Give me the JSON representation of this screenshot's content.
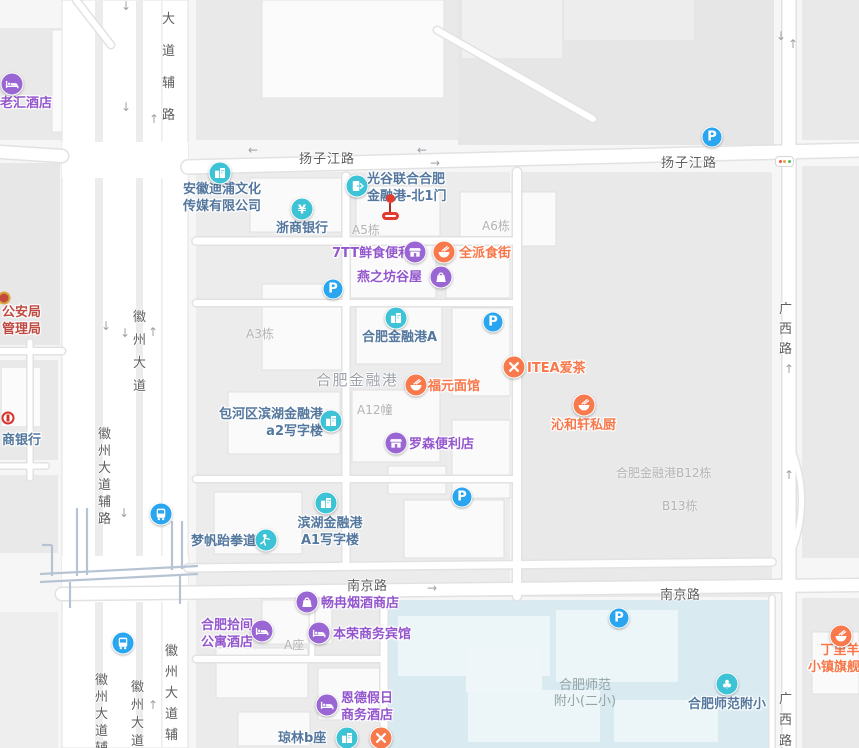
{
  "colors": {
    "teal": "#3ec3d6",
    "purple": "#9a66d4",
    "orange": "#f8794b",
    "parking_blue": "#2aa6f0",
    "transit_blue": "#2aa6f0",
    "poi_text_blue": "#54779e",
    "poi_text_purple": "#9356cd",
    "poi_text_orange": "#f8774a",
    "building_label_gray": "#b3b3b3",
    "area_label_gray": "#9da3aa",
    "school_text": "#92a4a6",
    "government_red": "#bf4a42",
    "road_text": "#5e5e5e",
    "marker_red": "#e23b30",
    "school_area_fill": "#d9eaf0",
    "bank_logo_red": "#d5342c"
  },
  "map": {
    "road_labels": [
      {
        "text": "扬子江路",
        "x": 299,
        "y": 148,
        "v": false,
        "ls": 1
      },
      {
        "text": "扬子江路",
        "x": 661,
        "y": 152,
        "v": false,
        "ls": 1
      },
      {
        "text": "南京路",
        "x": 347,
        "y": 575,
        "v": false,
        "ls": 0.5
      },
      {
        "text": "南京路",
        "x": 660,
        "y": 584,
        "v": false,
        "ls": 0.5
      },
      {
        "text": "徽州大道",
        "x": 132,
        "y": 306,
        "v": true,
        "gap": 23
      },
      {
        "text": "大道辅路",
        "x": 161,
        "y": 4,
        "v": true,
        "gap": 32
      },
      {
        "text": "徽州大道辅路",
        "x": 97,
        "y": 426,
        "v": true,
        "gap": 17
      },
      {
        "text": "徽州大道辅路",
        "x": 94,
        "y": 672,
        "v": true,
        "gap": 17
      },
      {
        "text": "徽州大道",
        "x": 130,
        "y": 679,
        "v": true,
        "gap": 18
      },
      {
        "text": "徽州大道辅路",
        "x": 164,
        "y": 641,
        "v": true,
        "gap": 21
      },
      {
        "text": "广西路",
        "x": 778,
        "y": 300,
        "v": true,
        "gap": 20
      },
      {
        "text": "广西路",
        "x": 778,
        "y": 689,
        "v": true,
        "gap": 21
      }
    ],
    "area_labels": [
      {
        "text": "合肥金融港",
        "x": 316,
        "y": 369,
        "kind": "district"
      },
      {
        "text": "合肥师范\n附小(二小)",
        "x": 547,
        "y": 678,
        "w": 76,
        "kind": "school"
      }
    ],
    "building_labels": [
      {
        "text": "A5栋",
        "x": 352,
        "y": 221
      },
      {
        "text": "A6栋",
        "x": 482,
        "y": 217
      },
      {
        "text": "A3栋",
        "x": 246,
        "y": 325
      },
      {
        "text": "A12幢",
        "x": 357,
        "y": 401
      },
      {
        "text": "合肥金融港B12栋",
        "x": 616,
        "y": 464
      },
      {
        "text": "B13栋",
        "x": 662,
        "y": 497
      },
      {
        "text": "A座",
        "x": 284,
        "y": 636
      }
    ],
    "pois": [
      {
        "id": "laohui-hotel",
        "icon": "bed",
        "icon_color": "purple",
        "ix": 12,
        "iy": 84,
        "text": "老汇酒店",
        "text_color": "purple",
        "tx": 0,
        "ty": 95
      },
      {
        "id": "anhui-dipu-media",
        "icon": "building",
        "icon_color": "teal",
        "ix": 220,
        "iy": 173,
        "text": "安徽迪浦文化\n传媒有限公司",
        "text_color": "blue",
        "tx": 183,
        "ty": 181
      },
      {
        "id": "zheshang-bank",
        "icon": "yen",
        "icon_color": "teal",
        "ix": 302,
        "iy": 209,
        "text": "浙商银行",
        "text_color": "blue",
        "tx": 276,
        "ty": 220
      },
      {
        "id": "guanggu-north-gate1",
        "icon": "door",
        "icon_color": "teal",
        "ix": 357,
        "iy": 186,
        "text": "光谷联合合肥\n金融港-北1门",
        "text_color": "blue",
        "tx": 367,
        "ty": 171
      },
      {
        "id": "7tt-convenience",
        "icon": "shop",
        "icon_color": "purple",
        "ix": 415,
        "iy": 252,
        "text": "7TT鲜食便利",
        "text_color": "purple",
        "tx": 332,
        "ty": 245
      },
      {
        "id": "quanpai-food-street",
        "icon": "bowl",
        "icon_color": "orange",
        "ix": 444,
        "iy": 252,
        "text": "全派食街",
        "text_color": "orange",
        "tx": 459,
        "ty": 245
      },
      {
        "id": "yanzhifang-guwu",
        "icon": "bag",
        "icon_color": "purple",
        "ix": 441,
        "iy": 277,
        "text": "燕之坊谷屋",
        "text_color": "purple",
        "tx": 357,
        "ty": 269
      },
      {
        "id": "hefei-jinronggang-a",
        "icon": "building",
        "icon_color": "teal",
        "ix": 396,
        "iy": 318,
        "text": "合肥金融港A",
        "text_color": "blue",
        "tx": 362,
        "ty": 329
      },
      {
        "id": "fuyuan-noodles",
        "icon": "bowl",
        "icon_color": "orange",
        "ix": 416,
        "iy": 385,
        "text": "福元面馆",
        "text_color": "orange",
        "tx": 428,
        "ty": 378
      },
      {
        "id": "itea-tea",
        "icon": "utensils",
        "icon_color": "orange",
        "ix": 514,
        "iy": 367,
        "text": "ITEA爱茶",
        "text_color": "orange",
        "tx": 527,
        "ty": 360
      },
      {
        "id": "qinhexuan-kitchen",
        "icon": "bowl",
        "icon_color": "orange",
        "ix": 584,
        "iy": 405,
        "text": "沁和轩私厨",
        "text_color": "orange",
        "tx": 551,
        "ty": 417
      },
      {
        "id": "baohe-a2-office",
        "icon": "building",
        "icon_color": "teal",
        "ix": 331,
        "iy": 421,
        "text": "包河区滨湖金融港\na2写字楼",
        "text_color": "blue",
        "tx": 217,
        "ty": 406,
        "w": 106,
        "align": "right"
      },
      {
        "id": "lawson-convenience",
        "icon": "shop",
        "icon_color": "purple",
        "ix": 396,
        "iy": 443,
        "text": "罗森便利店",
        "text_color": "purple",
        "tx": 409,
        "ty": 436
      },
      {
        "id": "binhu-a1-office",
        "icon": "building",
        "icon_color": "teal",
        "ix": 326,
        "iy": 503,
        "text": "滨湖金融港\nA1写字楼",
        "text_color": "blue",
        "tx": 295,
        "ty": 515,
        "w": 70,
        "align": "center"
      },
      {
        "id": "mengfan-taekwondo",
        "icon": "person",
        "icon_color": "teal",
        "ix": 266,
        "iy": 540,
        "text": "梦帆跆拳道",
        "text_color": "blue",
        "tx": 191,
        "ty": 533
      },
      {
        "id": "changran-tobacco",
        "icon": "bag",
        "icon_color": "purple",
        "ix": 307,
        "iy": 602,
        "text": "畅冉烟酒商店",
        "text_color": "purple",
        "tx": 321,
        "ty": 595
      },
      {
        "id": "hefei-shijian-hotel",
        "icon": "bed",
        "icon_color": "purple",
        "ix": 262,
        "iy": 631,
        "text": "合肥拾间\n公寓酒店",
        "text_color": "purple",
        "tx": 200,
        "ty": 617,
        "w": 54,
        "align": "center"
      },
      {
        "id": "benrong-hotel",
        "icon": "bed",
        "icon_color": "purple",
        "ix": 319,
        "iy": 633,
        "text": "本荣商务宾馆",
        "text_color": "purple",
        "tx": 333,
        "ty": 626
      },
      {
        "id": "ende-holiday-hotel",
        "icon": "bed",
        "icon_color": "purple",
        "ix": 327,
        "iy": 705,
        "text": "恩德假日\n商务酒店",
        "text_color": "purple",
        "tx": 341,
        "ty": 690
      },
      {
        "id": "qionglin-b",
        "icon": "building",
        "icon_color": "teal",
        "ix": 347,
        "iy": 738,
        "text": "琼林b座",
        "text_color": "blue",
        "tx": 278,
        "ty": 730
      },
      {
        "id": "sw-restaurant",
        "icon": "utensils",
        "icon_color": "orange",
        "ix": 381,
        "iy": 738,
        "text": null
      },
      {
        "id": "shifan-fuxiao",
        "icon": "tree",
        "icon_color": "teal",
        "ix": 727,
        "iy": 684,
        "text": "合肥师范附小",
        "text_color": "blue",
        "tx": 688,
        "ty": 696
      },
      {
        "id": "dingliyang-flagship",
        "icon": "bowl",
        "icon_color": "orange",
        "ix": 841,
        "iy": 636,
        "text": "丁里羊\n小镇旗舰店",
        "text_color": "orange",
        "tx": 808,
        "ty": 642,
        "w": 64,
        "align": "center"
      }
    ],
    "government": {
      "text": "公安局\n管理局",
      "x": 2,
      "y": 304,
      "badge_x": 4,
      "badge_y": 298
    },
    "cmb_bank": {
      "text": "商银行",
      "x": 2,
      "y": 432,
      "logo_x": 8,
      "logo_y": 418
    },
    "parking": {
      "label": "P",
      "spots": [
        {
          "x": 712,
          "y": 137
        },
        {
          "x": 333,
          "y": 289
        },
        {
          "x": 493,
          "y": 322
        },
        {
          "x": 462,
          "y": 497
        },
        {
          "x": 619,
          "y": 618
        }
      ]
    },
    "transit_stops": [
      {
        "x": 161,
        "y": 514
      },
      {
        "x": 123,
        "y": 643
      }
    ],
    "arrows": [
      {
        "d": "down",
        "x": 126,
        "y": 6
      },
      {
        "d": "down",
        "x": 126,
        "y": 107
      },
      {
        "d": "up",
        "x": 154,
        "y": 119
      },
      {
        "d": "down",
        "x": 106,
        "y": 326
      },
      {
        "d": "down",
        "x": 125,
        "y": 333
      },
      {
        "d": "up",
        "x": 153,
        "y": 332
      },
      {
        "d": "down",
        "x": 124,
        "y": 513
      },
      {
        "d": "up",
        "x": 153,
        "y": 705
      },
      {
        "d": "left",
        "x": 253,
        "y": 150
      },
      {
        "d": "left",
        "x": 422,
        "y": 150
      },
      {
        "d": "right",
        "x": 435,
        "y": 163
      },
      {
        "d": "right",
        "x": 432,
        "y": 588
      },
      {
        "d": "down",
        "x": 781,
        "y": 36
      },
      {
        "d": "up",
        "x": 793,
        "y": 44
      },
      {
        "d": "up",
        "x": 789,
        "y": 369
      },
      {
        "d": "up",
        "x": 789,
        "y": 475
      }
    ],
    "marker": {
      "x": 390,
      "y": 194
    },
    "traffic_light": {
      "x": 775,
      "y": 156,
      "colors": [
        "#e25b4d",
        "#f0a13c",
        "#57b95c"
      ]
    }
  }
}
